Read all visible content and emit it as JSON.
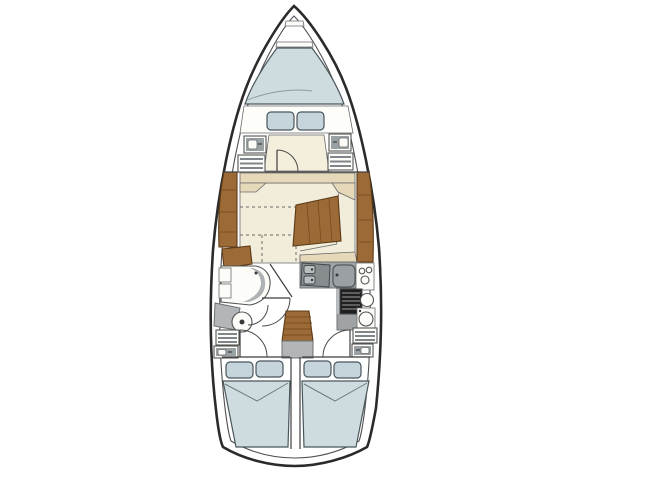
{
  "diagram": {
    "kind": "sailboat-interior-floor-plan",
    "view": "top-down",
    "text_on_image": "",
    "parts": [
      {
        "name": "anchor-locker",
        "location": "bow tip"
      },
      {
        "name": "v-berth",
        "location": "forward cabin",
        "pillows": 2
      },
      {
        "name": "forward-cabin-lockers",
        "count": 4
      },
      {
        "name": "forward-cabin-door",
        "type": "swing-door"
      },
      {
        "name": "salon-dinette",
        "features": [
          "convertible-dashed-outline"
        ]
      },
      {
        "name": "salon-table",
        "material": "wood"
      },
      {
        "name": "starboard-settee",
        "material": "upholstery"
      },
      {
        "name": "side-shelves",
        "material": "wood",
        "count": 2
      },
      {
        "name": "galley",
        "features": [
          "double-sink",
          "icebox",
          "stove-oven",
          "round-sinks",
          "burner-knobs"
        ]
      },
      {
        "name": "head-compartment",
        "features": [
          "vanity",
          "toilet",
          "bench",
          "doors"
        ]
      },
      {
        "name": "companionway-steps",
        "material": "wood"
      },
      {
        "name": "aft-cabin-port",
        "pillows": 2
      },
      {
        "name": "aft-cabin-starboard",
        "pillows": 2
      },
      {
        "name": "aft-cabin-doors",
        "count": 2
      }
    ]
  },
  "colors": {
    "background": "#ffffff",
    "hull_fill": "#ffffff",
    "hull_outline": "#2b2b2b",
    "floor_cream": "#f2ecda",
    "sole_cream": "#f4eedd",
    "upholstery_tan": "#e5d9ba",
    "berth_blue": "#cfdcdf",
    "pillow_blue": "#c6d4db",
    "wood_brown": "#9c6a36",
    "counter_gray": "#9fa3a6",
    "bench_gray": "#b3b6b8",
    "appliance_gray": "#878c8f",
    "icebox_gray": "#9aa0a3",
    "basin_gray": "#b9bec1",
    "stove_black": "#1f1f1f",
    "fixture_white": "#fcfcf8",
    "panel_white": "#fdfdfa"
  }
}
